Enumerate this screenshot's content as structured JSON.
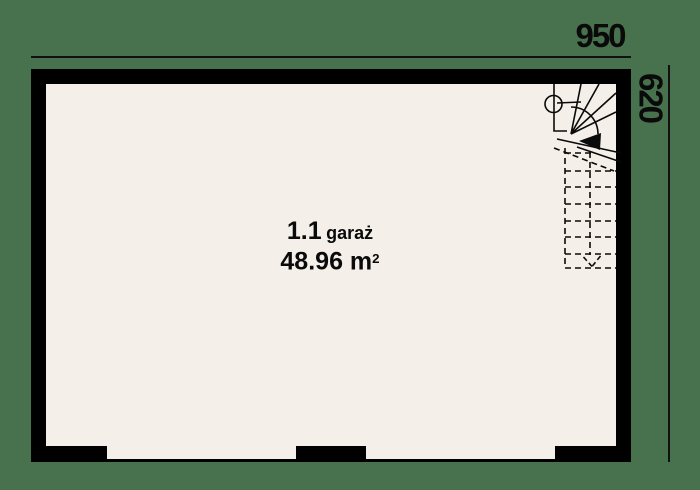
{
  "colors": {
    "background": "#48724d",
    "floor": "#f4efe8",
    "wall": "#000000",
    "line": "#111111"
  },
  "dimensions": {
    "top_width": "950",
    "right_height": "620"
  },
  "room": {
    "number": "1.1",
    "name": "garaż",
    "area": "48.96 m",
    "area_exponent": "2"
  },
  "icons": {
    "staircase": "winder-stair-with-dashed-lower-flight",
    "stair_column": "newel-post-circle",
    "direction_arrows": "up-arrow-solid-and-down-arrow-dashed"
  }
}
